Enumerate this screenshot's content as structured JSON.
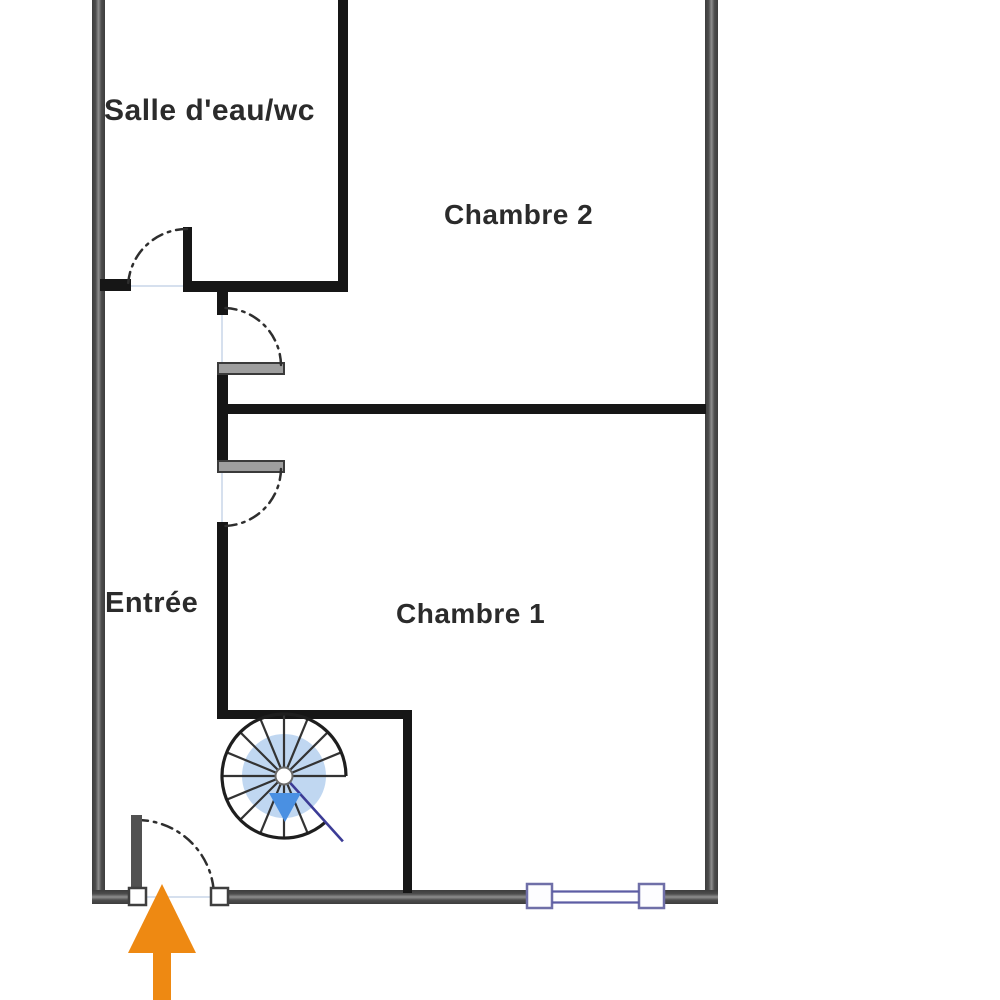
{
  "floorplan": {
    "type": "apartment-floor-plan",
    "rooms": {
      "bathroom_label": "Salle d'eau/wc",
      "bedroom2_label": "Chambre 2",
      "bedroom1_label": "Chambre 1",
      "entrance_label": "Entrée"
    },
    "symbols": {
      "staircase": "spiral-staircase-icon",
      "entry": "entry-arrow-icon",
      "window": "window-icon",
      "doors": "door-swing-arc"
    },
    "colors": {
      "wall_outer": "#3d3d3d",
      "wall_mid": "#8f8f8f",
      "wall_black": "#161616",
      "door_arc": "#2e2e2e",
      "jamb_fill": "#9e9e9e",
      "window_frame": "#6f6fa8",
      "stair_inner": "#b5d0ee",
      "stair_arrow": "#4a90e2",
      "stair_line": "#3c3c96",
      "entry_arrow": "#ee8912",
      "text": "#2b2b2b"
    }
  }
}
